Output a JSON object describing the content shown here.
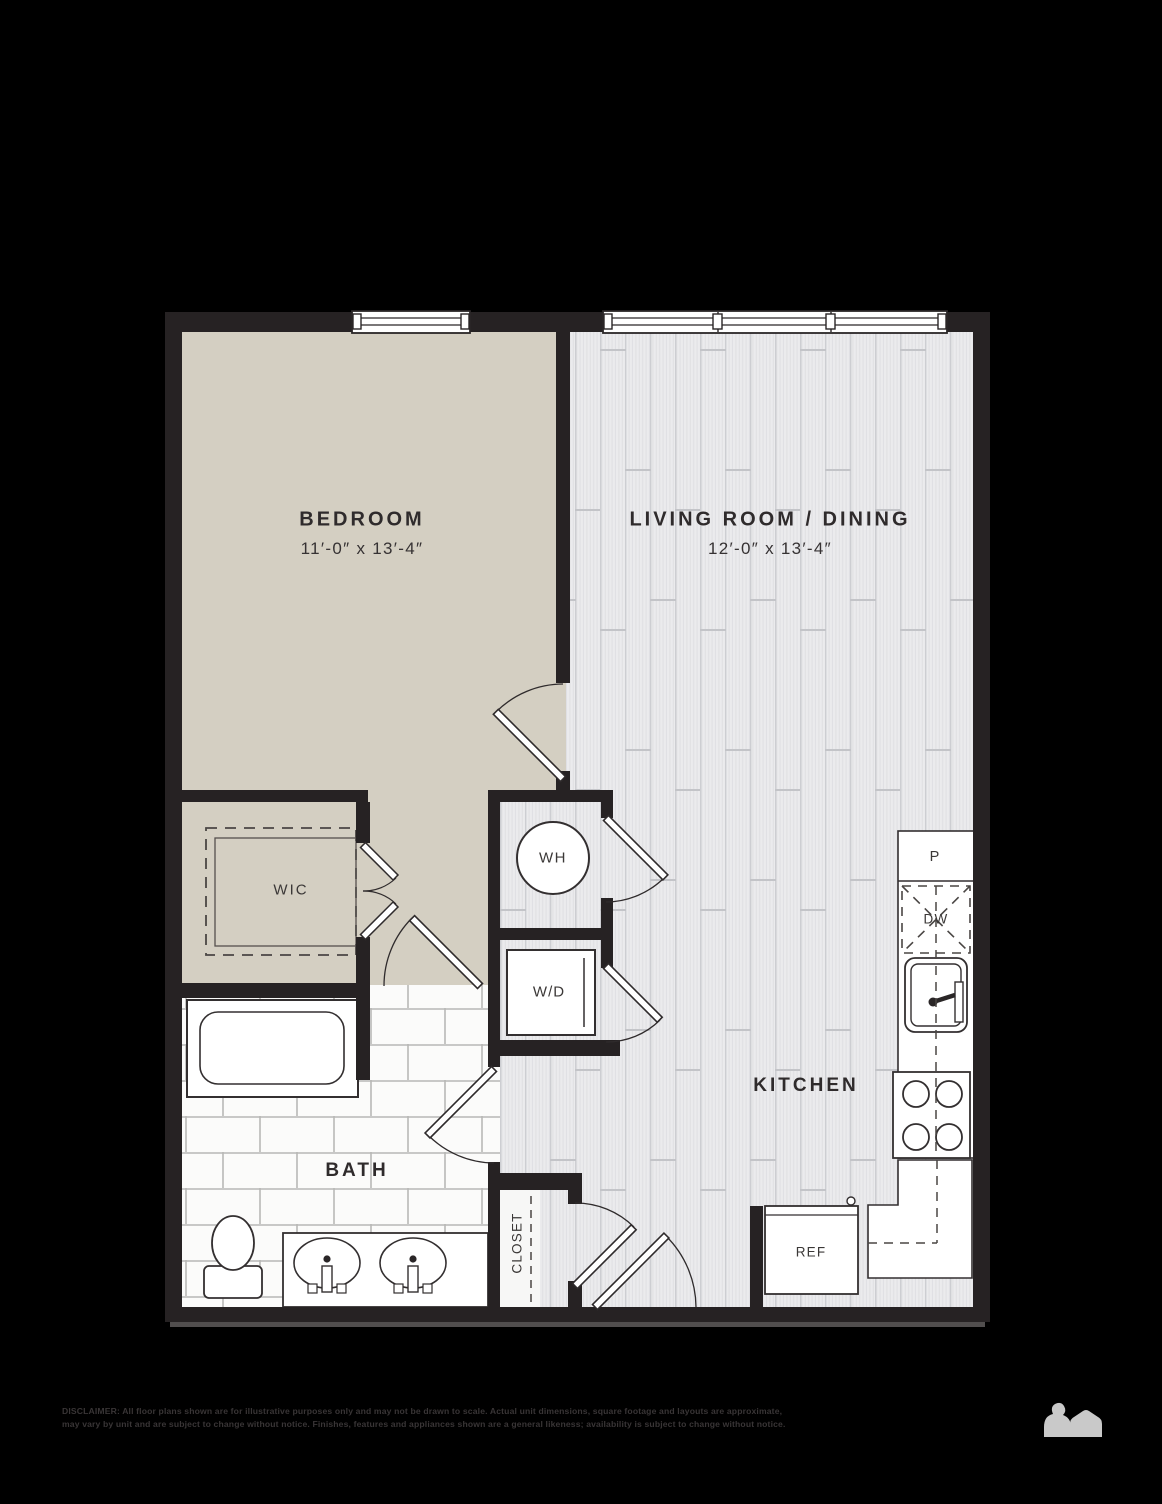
{
  "rooms": {
    "bedroom": {
      "label": "BEDROOM",
      "dims": "11′-0″ x 13′-4″"
    },
    "living_dining": {
      "label": "LIVING ROOM / DINING",
      "dims": "12′-0″ x 13′-4″"
    },
    "kitchen": {
      "label": "KITCHEN"
    },
    "bath": {
      "label": "BATH"
    },
    "walk_in_closet": {
      "label": "WIC"
    },
    "entry_closet": {
      "label": "CLOSET"
    }
  },
  "appliances": {
    "water_heater": "WH",
    "washer_dryer": "W/D",
    "refrigerator": "REF",
    "pantry": "P",
    "dishwasher": "DW"
  },
  "footer": {
    "disclaimer_line1": "DISCLAIMER: All floor plans shown are for illustrative purposes only and may not be drawn to scale. Actual unit dimensions, square footage and layouts are approximate,",
    "disclaimer_line2": "may vary by unit and are subject to change without notice. Finishes, features and appliances shown are a general likeness; availability is subject to change without notice."
  },
  "colors": {
    "background": "#000000",
    "wall": "#262223",
    "bedroom_floor": "#d4cfc2",
    "plank_floor": "#ebebed",
    "tile_floor": "#fbfbfa",
    "label_text": "#2f2b2c",
    "footer_text": "#393536",
    "logo_gray": "#c9c9c9"
  }
}
